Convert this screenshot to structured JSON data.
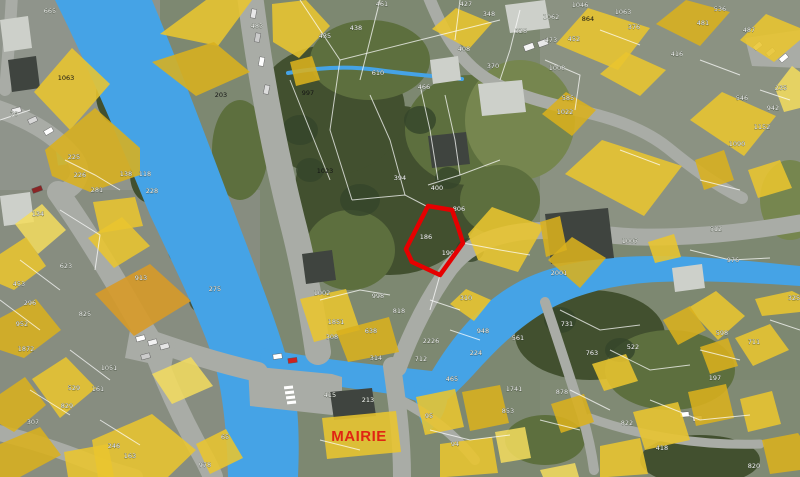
{
  "colors": {
    "water": "#45a3e6",
    "building": "#e9c52f",
    "building_dark": "#d9b01e",
    "building_light": "#f3dc5e",
    "building_orange": "#d79a28",
    "parcel_line": "#ffffff",
    "highlight": "#e60000",
    "label": "#ffffff",
    "label_dark": "#141414",
    "road": "#a9aca6",
    "mairie": "#e02513"
  },
  "labels": {
    "mairie": "MAIRIE"
  },
  "highlighted_parcel": {
    "numbers": [
      "186",
      "190"
    ]
  },
  "parcel_labels": [
    {
      "t": "665",
      "x": 50,
      "y": 13,
      "c": "w"
    },
    {
      "t": "70",
      "x": 14,
      "y": 116,
      "c": "w"
    },
    {
      "t": "1063",
      "x": 66,
      "y": 80,
      "c": "k"
    },
    {
      "t": "203",
      "x": 221,
      "y": 97,
      "c": "k"
    },
    {
      "t": "225",
      "x": 74,
      "y": 159,
      "c": "w"
    },
    {
      "t": "226",
      "x": 80,
      "y": 177,
      "c": "w"
    },
    {
      "t": "138",
      "x": 126,
      "y": 176,
      "c": "w"
    },
    {
      "t": "118",
      "x": 145,
      "y": 176,
      "c": "w"
    },
    {
      "t": "228",
      "x": 152,
      "y": 193,
      "c": "w"
    },
    {
      "t": "281",
      "x": 97,
      "y": 192,
      "c": "w"
    },
    {
      "t": "483",
      "x": 257,
      "y": 28,
      "c": "w"
    },
    {
      "t": "435",
      "x": 325,
      "y": 38,
      "c": "w"
    },
    {
      "t": "438",
      "x": 356,
      "y": 30,
      "c": "w"
    },
    {
      "t": "461",
      "x": 382,
      "y": 6,
      "c": "w"
    },
    {
      "t": "427",
      "x": 466,
      "y": 6,
      "c": "w"
    },
    {
      "t": "997",
      "x": 308,
      "y": 95,
      "c": "k"
    },
    {
      "t": "1023",
      "x": 325,
      "y": 173,
      "c": "k"
    },
    {
      "t": "610",
      "x": 378,
      "y": 75,
      "c": "w"
    },
    {
      "t": "466",
      "x": 424,
      "y": 89,
      "c": "w"
    },
    {
      "t": "394",
      "x": 400,
      "y": 180,
      "c": "w"
    },
    {
      "t": "408",
      "x": 464,
      "y": 51,
      "c": "w"
    },
    {
      "t": "370",
      "x": 493,
      "y": 68,
      "c": "w"
    },
    {
      "t": "348",
      "x": 489,
      "y": 16,
      "c": "w"
    },
    {
      "t": "328",
      "x": 521,
      "y": 33,
      "c": "w"
    },
    {
      "t": "400",
      "x": 437,
      "y": 190,
      "c": "w"
    },
    {
      "t": "806",
      "x": 459,
      "y": 211,
      "c": "w"
    },
    {
      "t": "186",
      "x": 426,
      "y": 239,
      "c": "w"
    },
    {
      "t": "190",
      "x": 448,
      "y": 255,
      "c": "w"
    },
    {
      "t": "1046",
      "x": 580,
      "y": 7,
      "c": "w"
    },
    {
      "t": "1062",
      "x": 551,
      "y": 19,
      "c": "w"
    },
    {
      "t": "1063",
      "x": 623,
      "y": 14,
      "c": "w"
    },
    {
      "t": "864",
      "x": 588,
      "y": 21,
      "c": "k"
    },
    {
      "t": "452",
      "x": 574,
      "y": 41,
      "c": "w"
    },
    {
      "t": "473",
      "x": 551,
      "y": 42,
      "c": "w"
    },
    {
      "t": "1008",
      "x": 557,
      "y": 70,
      "c": "w"
    },
    {
      "t": "536",
      "x": 720,
      "y": 11,
      "c": "w"
    },
    {
      "t": "481",
      "x": 703,
      "y": 25,
      "c": "w"
    },
    {
      "t": "487",
      "x": 749,
      "y": 32,
      "c": "w"
    },
    {
      "t": "416",
      "x": 677,
      "y": 56,
      "c": "w"
    },
    {
      "t": "376",
      "x": 634,
      "y": 29,
      "c": "w"
    },
    {
      "t": "235",
      "x": 781,
      "y": 90,
      "c": "w"
    },
    {
      "t": "546",
      "x": 742,
      "y": 100,
      "c": "w"
    },
    {
      "t": "942",
      "x": 773,
      "y": 110,
      "c": "w"
    },
    {
      "t": "1152",
      "x": 762,
      "y": 129,
      "c": "w"
    },
    {
      "t": "1090",
      "x": 737,
      "y": 146,
      "c": "w"
    },
    {
      "t": "585",
      "x": 568,
      "y": 100,
      "c": "w"
    },
    {
      "t": "1022",
      "x": 565,
      "y": 114,
      "c": "w"
    },
    {
      "t": "134",
      "x": 38,
      "y": 216,
      "c": "w"
    },
    {
      "t": "453",
      "x": 19,
      "y": 286,
      "c": "w"
    },
    {
      "t": "296",
      "x": 30,
      "y": 305,
      "c": "w"
    },
    {
      "t": "952",
      "x": 22,
      "y": 326,
      "c": "w"
    },
    {
      "t": "1872",
      "x": 26,
      "y": 351,
      "c": "w"
    },
    {
      "t": "623",
      "x": 66,
      "y": 268,
      "c": "w"
    },
    {
      "t": "825",
      "x": 85,
      "y": 316,
      "c": "w"
    },
    {
      "t": "913",
      "x": 141,
      "y": 280,
      "c": "w"
    },
    {
      "t": "275",
      "x": 215,
      "y": 291,
      "c": "w"
    },
    {
      "t": "1051",
      "x": 109,
      "y": 370,
      "c": "w"
    },
    {
      "t": "161",
      "x": 98,
      "y": 391,
      "c": "w"
    },
    {
      "t": "829",
      "x": 67,
      "y": 408,
      "c": "w"
    },
    {
      "t": "529",
      "x": 74,
      "y": 390,
      "c": "w"
    },
    {
      "t": "307",
      "x": 33,
      "y": 424,
      "c": "w"
    },
    {
      "t": "246",
      "x": 114,
      "y": 448,
      "c": "w"
    },
    {
      "t": "163",
      "x": 130,
      "y": 458,
      "c": "w"
    },
    {
      "t": "978",
      "x": 205,
      "y": 467,
      "c": "w"
    },
    {
      "t": "65",
      "x": 225,
      "y": 439,
      "c": "w"
    },
    {
      "t": "1002",
      "x": 322,
      "y": 295,
      "c": "w"
    },
    {
      "t": "998",
      "x": 378,
      "y": 298,
      "c": "w"
    },
    {
      "t": "818",
      "x": 399,
      "y": 313,
      "c": "w"
    },
    {
      "t": "1851",
      "x": 336,
      "y": 324,
      "c": "w"
    },
    {
      "t": "308",
      "x": 332,
      "y": 339,
      "c": "w"
    },
    {
      "t": "638",
      "x": 371,
      "y": 333,
      "c": "w"
    },
    {
      "t": "314",
      "x": 376,
      "y": 360,
      "c": "w"
    },
    {
      "t": "712",
      "x": 421,
      "y": 361,
      "c": "w"
    },
    {
      "t": "2226",
      "x": 431,
      "y": 343,
      "c": "w"
    },
    {
      "t": "310",
      "x": 466,
      "y": 300,
      "c": "w"
    },
    {
      "t": "948",
      "x": 483,
      "y": 333,
      "c": "w"
    },
    {
      "t": "224",
      "x": 476,
      "y": 355,
      "c": "w"
    },
    {
      "t": "561",
      "x": 518,
      "y": 340,
      "c": "w"
    },
    {
      "t": "465",
      "x": 452,
      "y": 381,
      "c": "w"
    },
    {
      "t": "1741",
      "x": 514,
      "y": 391,
      "c": "w"
    },
    {
      "t": "853",
      "x": 508,
      "y": 413,
      "c": "w"
    },
    {
      "t": "95",
      "x": 429,
      "y": 418,
      "c": "w"
    },
    {
      "t": "94",
      "x": 455,
      "y": 446,
      "c": "w"
    },
    {
      "t": "415",
      "x": 330,
      "y": 397,
      "c": "w"
    },
    {
      "t": "213",
      "x": 368,
      "y": 402,
      "c": "w"
    },
    {
      "t": "2001",
      "x": 559,
      "y": 275,
      "c": "w"
    },
    {
      "t": "1007",
      "x": 630,
      "y": 243,
      "c": "w"
    },
    {
      "t": "512",
      "x": 716,
      "y": 231,
      "c": "w"
    },
    {
      "t": "976",
      "x": 733,
      "y": 262,
      "c": "w"
    },
    {
      "t": "325",
      "x": 794,
      "y": 300,
      "c": "w"
    },
    {
      "t": "731",
      "x": 567,
      "y": 326,
      "c": "w"
    },
    {
      "t": "763",
      "x": 592,
      "y": 355,
      "c": "w"
    },
    {
      "t": "711",
      "x": 754,
      "y": 344,
      "c": "w"
    },
    {
      "t": "522",
      "x": 633,
      "y": 349,
      "c": "w"
    },
    {
      "t": "598",
      "x": 722,
      "y": 335,
      "c": "w"
    },
    {
      "t": "197",
      "x": 715,
      "y": 380,
      "c": "w"
    },
    {
      "t": "878",
      "x": 562,
      "y": 394,
      "c": "w"
    },
    {
      "t": "822",
      "x": 627,
      "y": 425,
      "c": "w"
    },
    {
      "t": "418",
      "x": 662,
      "y": 450,
      "c": "w"
    },
    {
      "t": "820",
      "x": 754,
      "y": 468,
      "c": "w"
    }
  ]
}
